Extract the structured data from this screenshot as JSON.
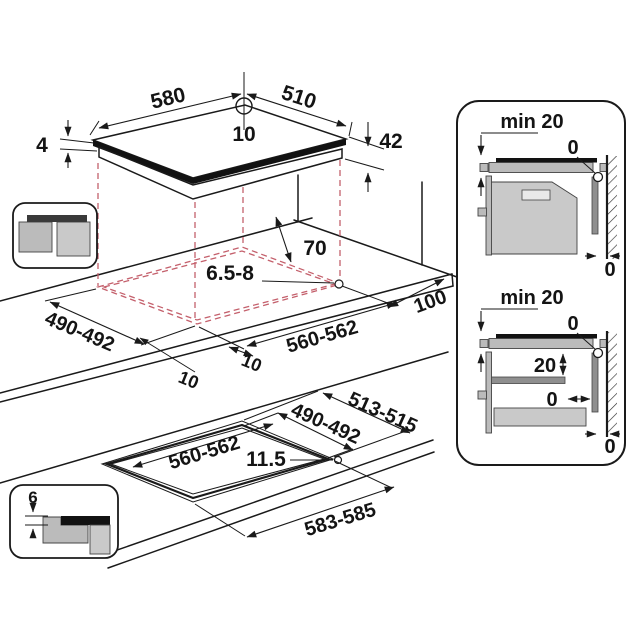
{
  "colors": {
    "line": "#1a1a1a",
    "dashed_projection": "#c4606c",
    "glass_black": "#121212",
    "gray_mid": "#bbbbbb",
    "gray_light": "#c9c9c9",
    "gray_dark": "#8f8f8f"
  },
  "icons": {
    "surface_mount": "surface-mount-icon",
    "flush_mount": "flush-mount-icon"
  },
  "hob": {
    "width": "580",
    "depth": "510",
    "rear_hole_offset": "10",
    "glass_thickness": "4",
    "body_height": "42"
  },
  "worktop_cutout": {
    "rear_clearance": "70",
    "hole_diameter": "6.5-8",
    "depth": "490-492",
    "width": "560-562",
    "side_clearance": "100",
    "front_overhang": "10",
    "side_overhang": "10"
  },
  "flush_cutout": {
    "outer_depth": "513-515",
    "depth": "490-492",
    "width": "560-562",
    "ledge": "11.5",
    "outer_width": "583-585",
    "recess_depth": "6"
  },
  "clearance_top": {
    "min_thickness": "min 20",
    "wall_gap": "0",
    "rear_gap": "0"
  },
  "clearance_bottom": {
    "min_thickness": "min 20",
    "wall_gap": "0",
    "shelf_gap": "20",
    "side_gap": "0",
    "rear_gap": "0"
  }
}
